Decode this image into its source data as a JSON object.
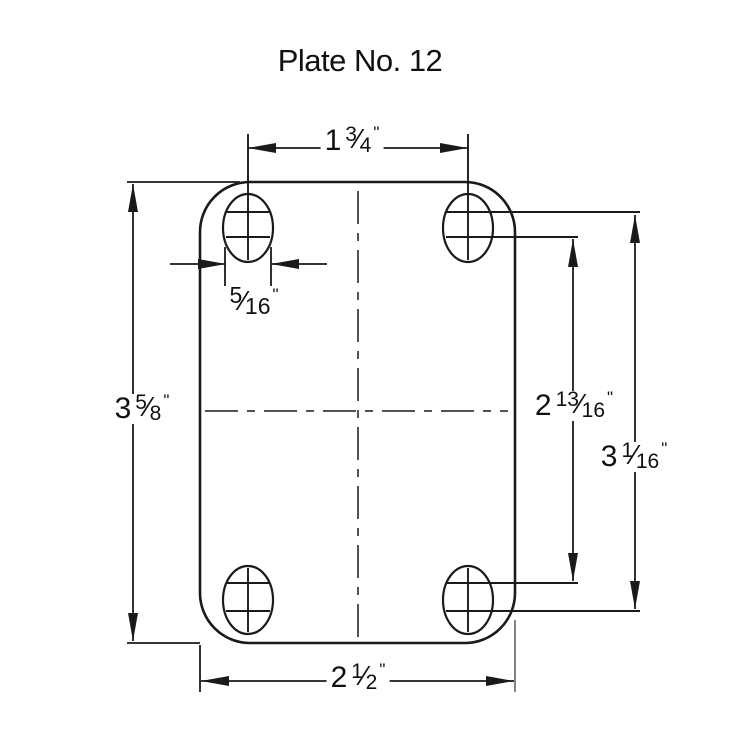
{
  "title": "Plate No. 12",
  "colors": {
    "line": "#1a1a1a",
    "muted_line": "#777777",
    "background": "#ffffff"
  },
  "dimensions": {
    "top_width": {
      "whole": "1",
      "num": "3",
      "slash": "⁄",
      "den": "4",
      "unit": "\""
    },
    "left_height": {
      "whole": "3",
      "num": "5",
      "slash": "⁄",
      "den": "8",
      "unit": "\""
    },
    "slot_width": {
      "num": "5",
      "slash": "⁄",
      "den": "16",
      "unit": "\""
    },
    "right_inner": {
      "whole": "2",
      "num": "13",
      "slash": "⁄",
      "den": "16",
      "unit": "\""
    },
    "right_outer": {
      "whole": "3",
      "num": "1",
      "slash": "⁄",
      "den": "16",
      "unit": "\""
    },
    "bottom_width": {
      "whole": "2",
      "num": "1",
      "slash": "⁄",
      "den": "2",
      "unit": "\""
    }
  }
}
